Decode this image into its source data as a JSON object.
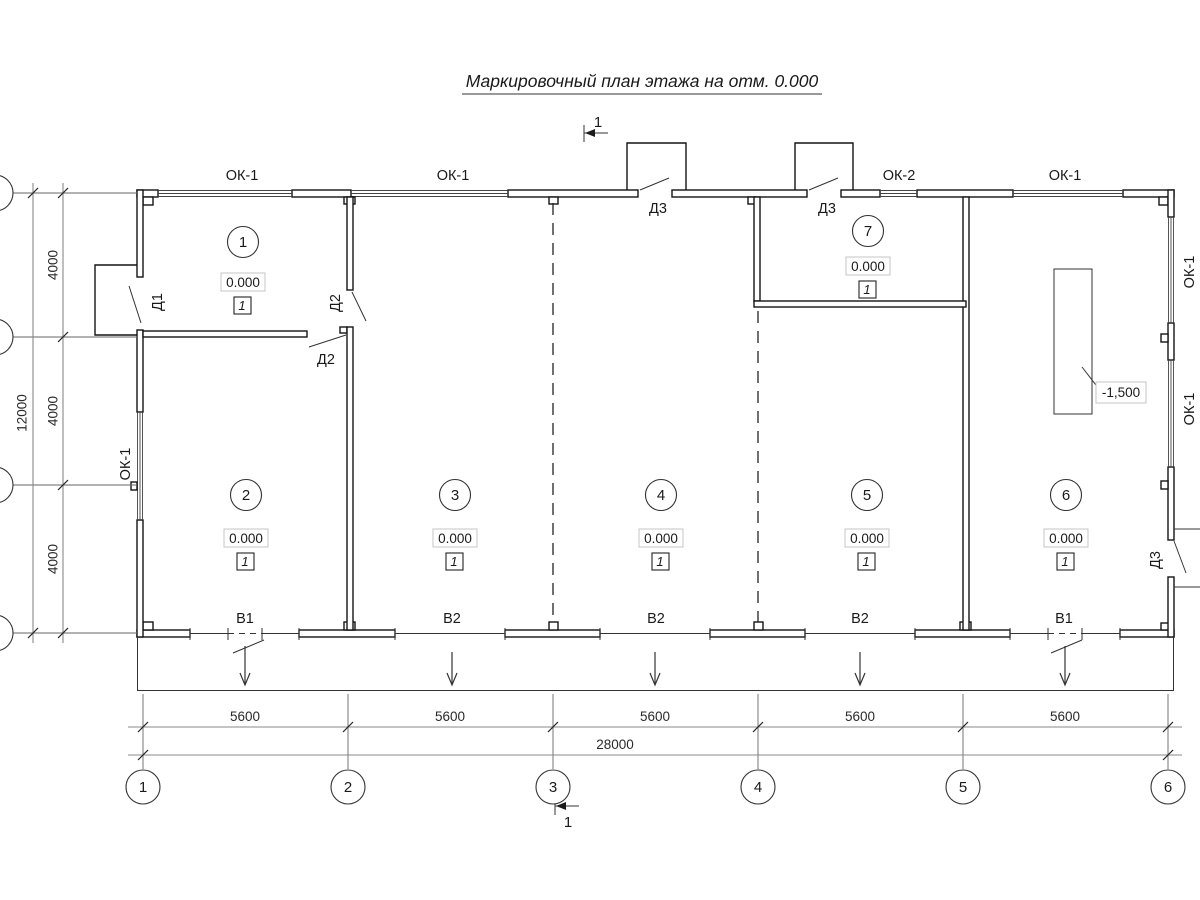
{
  "title": "Маркировочный план этажа на отм. 0.000",
  "section_marks": {
    "top": "1",
    "bottom": "1"
  },
  "windows": {
    "top": [
      "ОК-1",
      "ОК-1",
      "ОК-2",
      "ОК-1"
    ],
    "left": "ОК-1",
    "right": [
      "ОК-1",
      "ОК-1"
    ]
  },
  "doors": {
    "d1": "Д1",
    "d2_vertical": "Д2",
    "d2_horizontal": "Д2",
    "d3_top": [
      "Д3",
      "Д3"
    ],
    "d3_right": "Д3"
  },
  "vents": [
    "В1",
    "В2",
    "В2",
    "В2",
    "В1"
  ],
  "rooms": [
    {
      "number": "1",
      "elevation": "0.000",
      "zone": "1"
    },
    {
      "number": "2",
      "elevation": "0.000",
      "zone": "1"
    },
    {
      "number": "3",
      "elevation": "0.000",
      "zone": "1"
    },
    {
      "number": "4",
      "elevation": "0.000",
      "zone": "1"
    },
    {
      "number": "5",
      "elevation": "0.000",
      "zone": "1"
    },
    {
      "number": "6",
      "elevation": "0.000",
      "zone": "1"
    },
    {
      "number": "7",
      "elevation": "0.000",
      "zone": "1"
    }
  ],
  "pit_elevation": "-1,500",
  "dim_horizontal": {
    "segments": [
      "5600",
      "5600",
      "5600",
      "5600",
      "5600"
    ],
    "total": "28000"
  },
  "dim_vertical": {
    "segments": [
      "4000",
      "4000",
      "4000"
    ],
    "total": "12000"
  },
  "axes_bottom": [
    "1",
    "2",
    "3",
    "4",
    "5",
    "6"
  ]
}
